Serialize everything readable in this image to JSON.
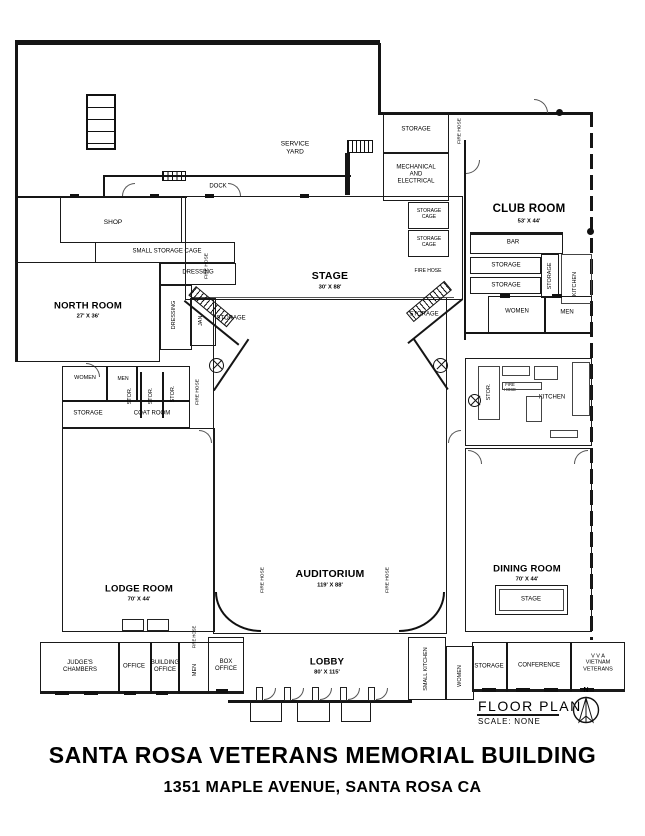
{
  "title": {
    "line1": "SANTA ROSA VETERANS MEMORIAL BUILDING",
    "line2": "1351 MAPLE AVENUE, SANTA ROSA CA"
  },
  "legend": {
    "floor_plan": "FLOOR PLAN",
    "scale": "SCALE: NONE",
    "north": "N"
  },
  "labels": {
    "service_yard": "SERVICE YARD",
    "dock": "DOCK",
    "shop": "SHOP",
    "small_storage_cage": "SMALL STORAGE CAGE",
    "dressing": "DRESSING",
    "jan": "JAN.",
    "storage": "STORAGE",
    "stor": "STOR.",
    "storage_cage": "STORAGE CAGE",
    "fire_hose": "FIRE HOSE",
    "mechanical": "MECHANICAL AND ELECTRICAL",
    "bar": "BAR",
    "women": "WOMEN",
    "men": "MEN",
    "kitchen": "KITCHEN",
    "coat_room": "COAT ROOM",
    "stage_small": "STAGE",
    "judges_chambers": "JUDGE'S CHAMBERS",
    "office": "OFFICE",
    "building_office": "BUILDING OFFICE",
    "box_office": "BOX OFFICE",
    "small_kitchen": "SMALL KITCHEN",
    "conference": "CONFERENCE",
    "vva_line1": "V V A",
    "vva_line2": "VIETNAM",
    "vva_line3": "VETERANS"
  },
  "rooms": {
    "north_room": {
      "name": "NORTH ROOM",
      "dims": "27' X 36'"
    },
    "stage": {
      "name": "STAGE",
      "dims": "30' X 88'"
    },
    "club_room": {
      "name": "CLUB ROOM",
      "dims": "53' X 44'"
    },
    "auditorium": {
      "name": "AUDITORIUM",
      "dims": "119' X 88'"
    },
    "lodge_room": {
      "name": "LODGE ROOM",
      "dims": "70' X 44'"
    },
    "dining_room": {
      "name": "DINING ROOM",
      "dims": "70' X 44'"
    },
    "lobby": {
      "name": "LOBBY",
      "dims": "80' X 115'"
    }
  }
}
